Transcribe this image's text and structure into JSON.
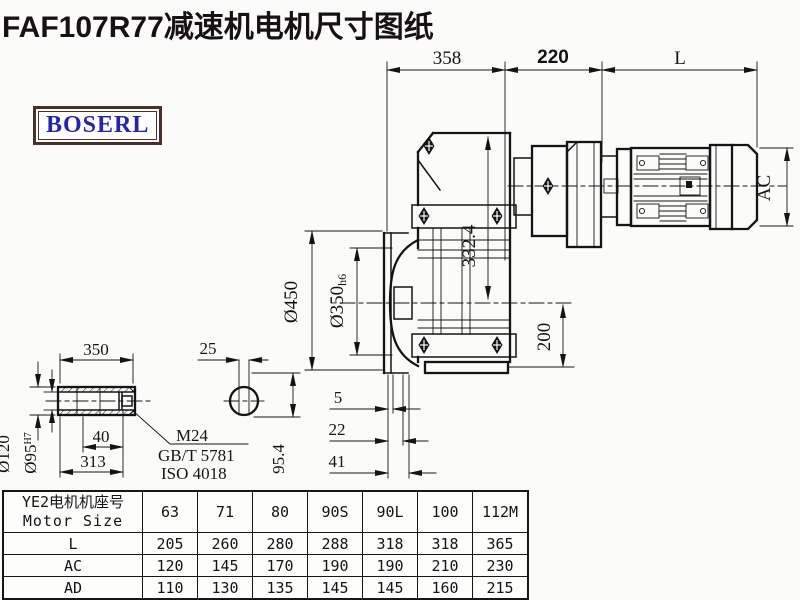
{
  "title": "FAF107R77减速机电机尺寸图纸",
  "logo": {
    "text": "BOSERL"
  },
  "colors": {
    "title": "#171115",
    "logo_text": "#2424ad",
    "logo_border": "#4a3029",
    "line": "#141414"
  },
  "drawing": {
    "dims": {
      "top_width_gearbox": "358",
      "top_width_adapter": "220",
      "top_width_motor": "L",
      "height_332": "332.4",
      "flange_od": "Ø450",
      "flange_spigot": "Ø350",
      "flange_spigot_tol": "h6",
      "bottom_200": "200",
      "motor_ac": "AC",
      "flange_5": "5",
      "flange_22": "22",
      "flange_41": "41",
      "shaft_len": "350",
      "key_width": "25",
      "shaft_od": "Ø120",
      "shaft_bore": "Ø95",
      "shaft_bore_tol": "H7",
      "bolt_depth": "40",
      "shaft_313": "313",
      "bolt_spec": "M24",
      "bolt_std1": "GB/T 5781",
      "bolt_std2": "ISO 4018",
      "key_954": "95.4"
    }
  },
  "table": {
    "header": {
      "line1": "YE2电机机座号",
      "line2": "Motor Size"
    },
    "columns": [
      "63",
      "71",
      "80",
      "90S",
      "90L",
      "100",
      "112M"
    ],
    "rows": [
      {
        "label": "L",
        "values": [
          "205",
          "260",
          "280",
          "288",
          "318",
          "318",
          "365"
        ]
      },
      {
        "label": "AC",
        "values": [
          "120",
          "145",
          "170",
          "190",
          "190",
          "210",
          "230"
        ]
      },
      {
        "label": "AD",
        "values": [
          "110",
          "130",
          "135",
          "145",
          "145",
          "160",
          "215"
        ]
      }
    ]
  }
}
